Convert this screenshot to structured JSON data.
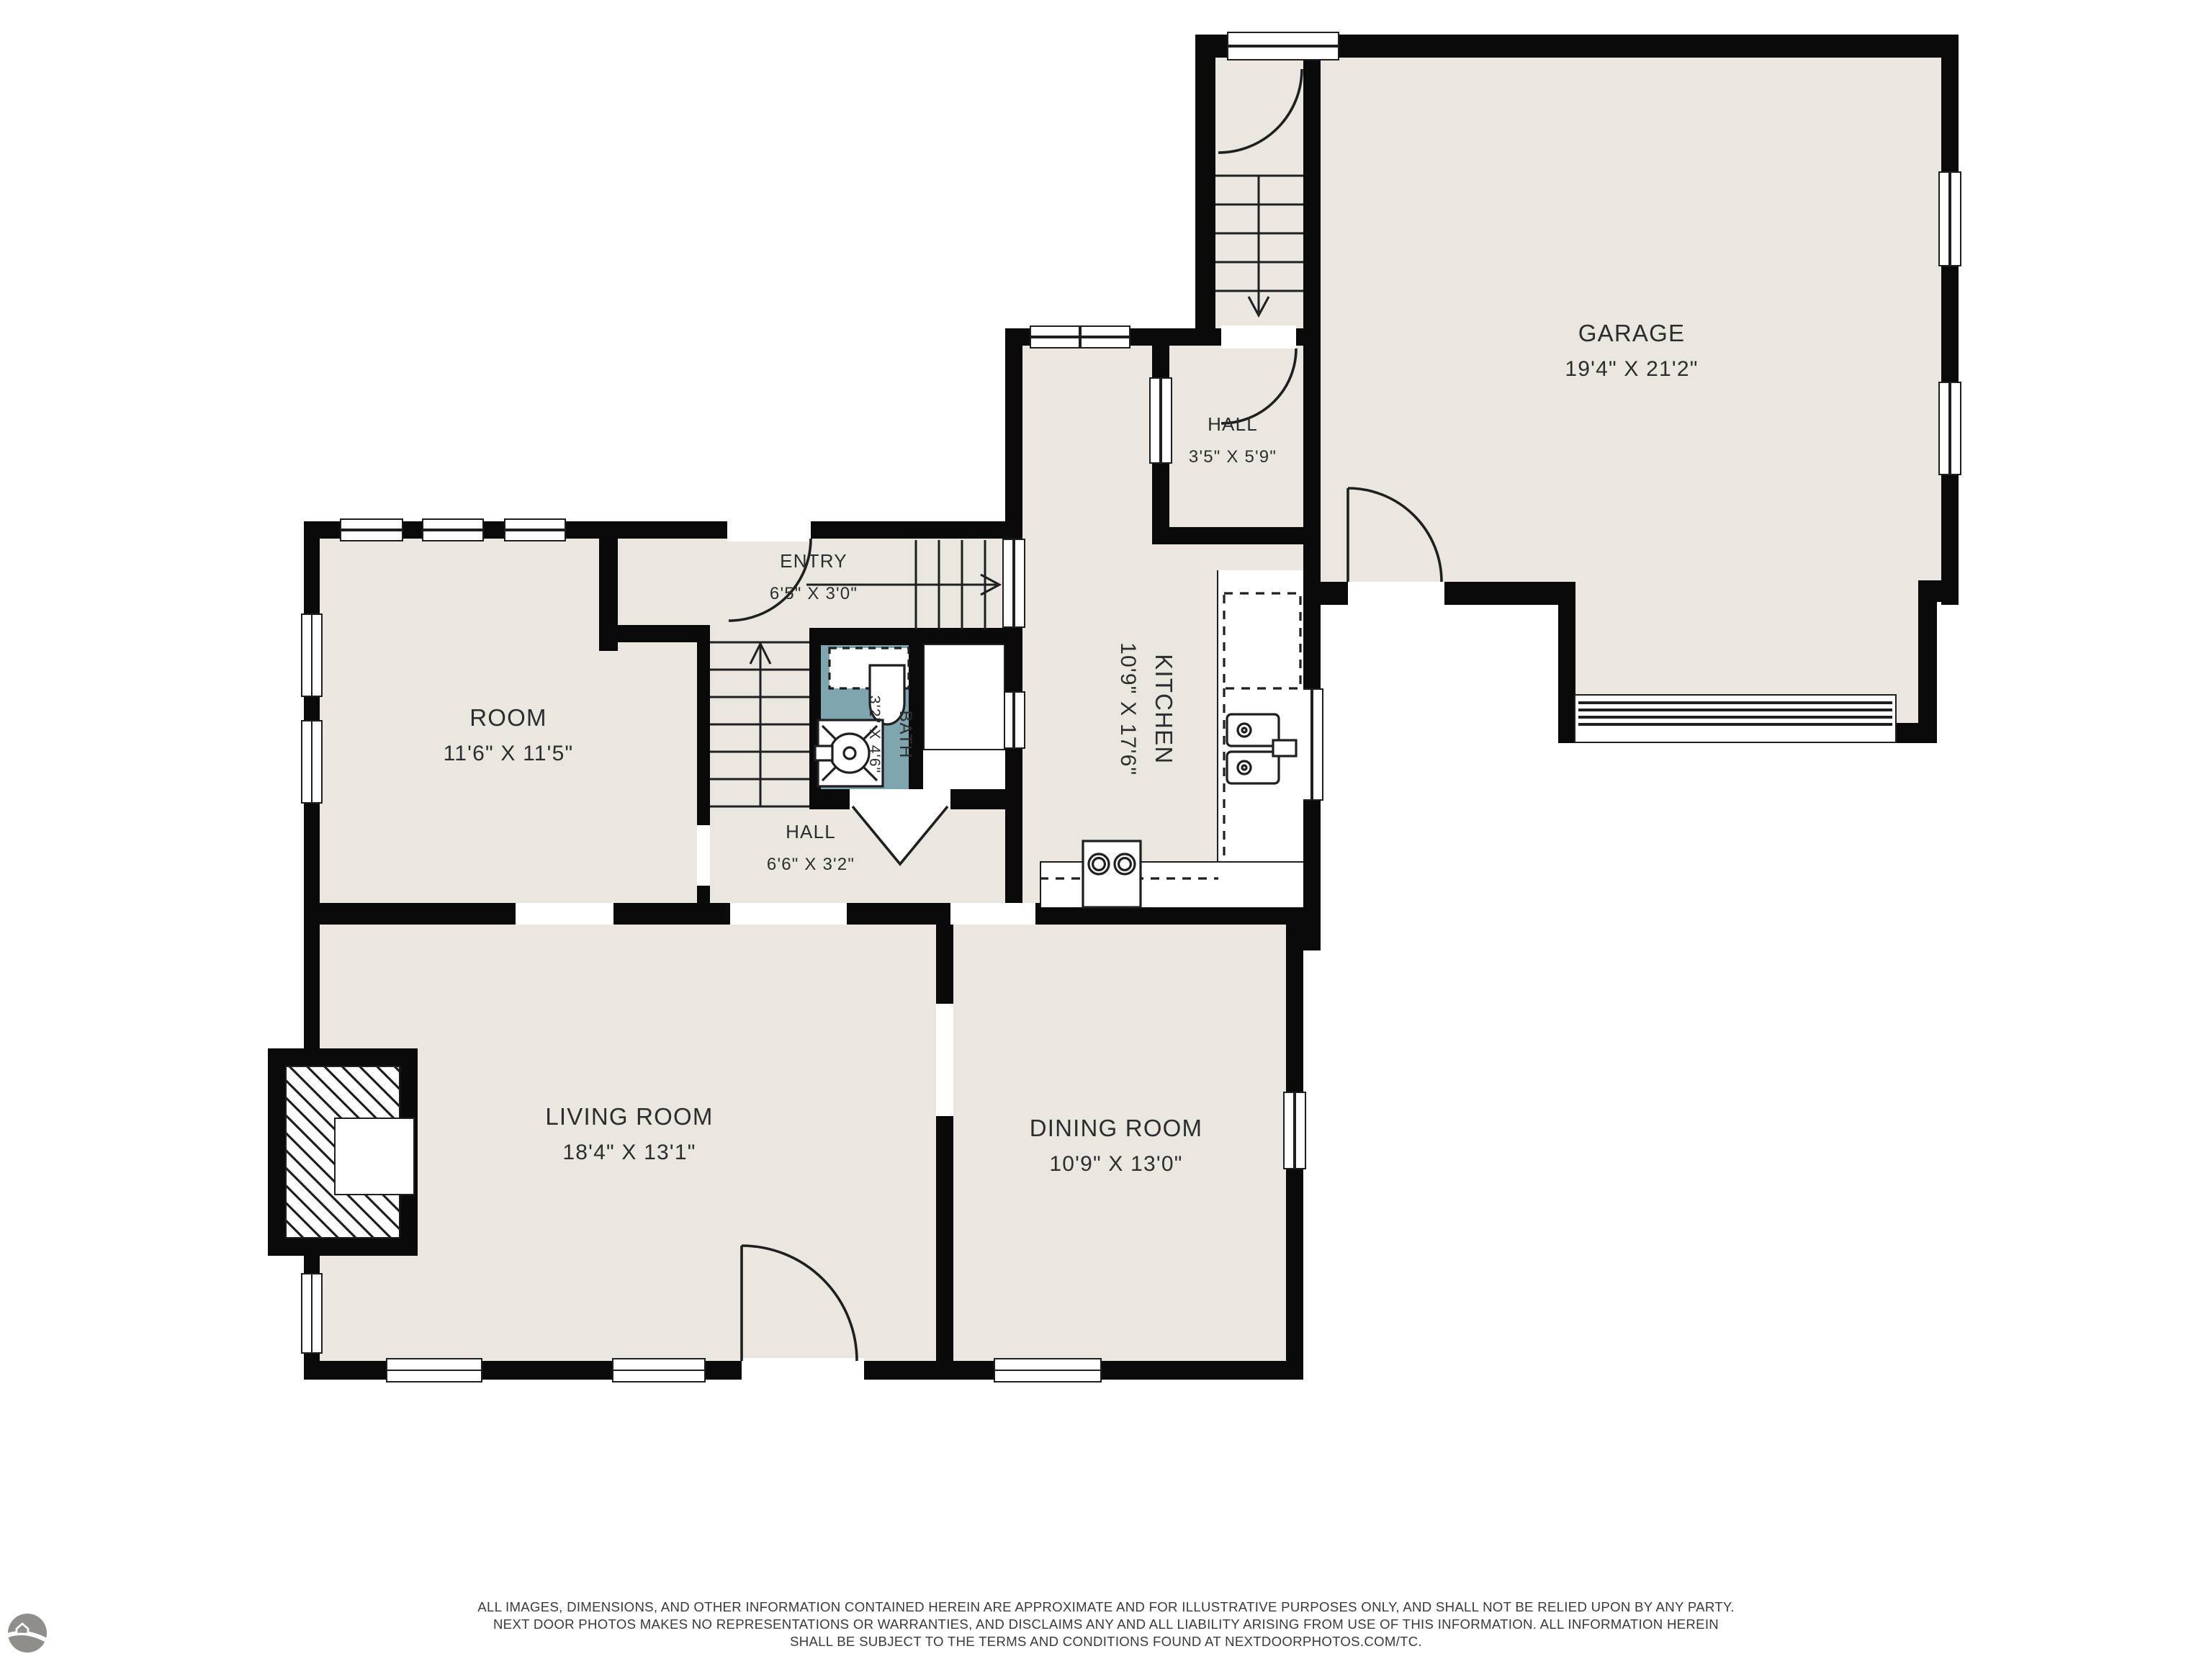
{
  "rooms": [
    {
      "id": "garage",
      "name": "GARAGE",
      "dims": "19'4\" X 21'2\""
    },
    {
      "id": "hall-upper",
      "name": "HALL",
      "dims": "3'5\" X 5'9\""
    },
    {
      "id": "kitchen",
      "name": "KITCHEN",
      "dims": "10'9\" X 17'6\""
    },
    {
      "id": "entry",
      "name": "ENTRY",
      "dims": "6'5\" X 3'0\""
    },
    {
      "id": "room",
      "name": "ROOM",
      "dims": "11'6\" X 11'5\""
    },
    {
      "id": "bath",
      "name": "BATH",
      "dims": "3'2\" X 4'6\""
    },
    {
      "id": "hall-lower",
      "name": "HALL",
      "dims": "6'6\" X 3'2\""
    },
    {
      "id": "living-room",
      "name": "LIVING ROOM",
      "dims": "18'4\" X 13'1\""
    },
    {
      "id": "dining-room",
      "name": "DINING ROOM",
      "dims": "10'9\" X 13'0\""
    }
  ],
  "footer": {
    "line1": "ALL IMAGES, DIMENSIONS, AND OTHER INFORMATION CONTAINED HEREIN ARE APPROXIMATE AND FOR ILLUSTRATIVE PURPOSES ONLY, AND SHALL NOT BE RELIED UPON BY ANY PARTY.",
    "line2": "NEXT DOOR PHOTOS MAKES NO REPRESENTATIONS OR WARRANTIES, AND DISCLAIMS ANY AND ALL LIABILITY ARISING FROM USE OF THIS INFORMATION. ALL INFORMATION HEREIN",
    "line3": "SHALL BE SUBJECT TO THE TERMS AND CONDITIONS FOUND AT NEXTDOORPHOTOS.COM/TC."
  },
  "logo": {
    "name": "next-door-photos-logo"
  },
  "colors": {
    "floor": "#e9e7df",
    "wet_floor": "#7fa6ae",
    "wall": "#0a0a0a",
    "accent_line": "#1f1f1f"
  }
}
